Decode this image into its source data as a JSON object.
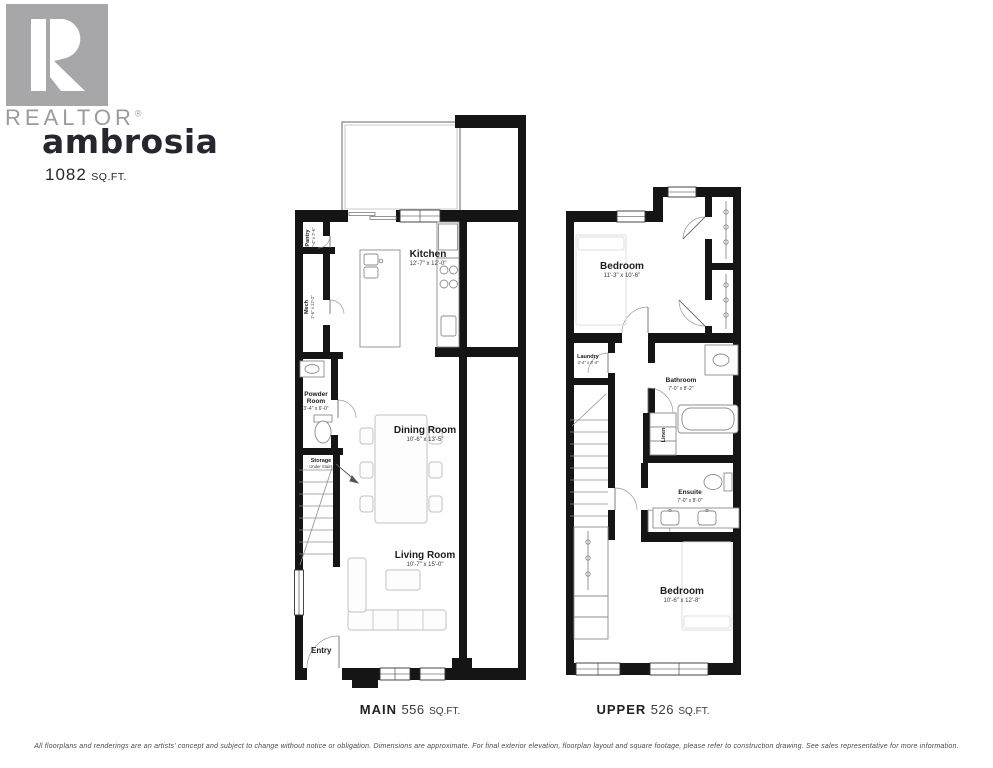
{
  "brand": {
    "realtor_label": "REALTOR",
    "registered_mark": "®"
  },
  "header": {
    "plan_name": "ambrosia",
    "total_area_value": "1082",
    "total_area_unit": "SQ.FT."
  },
  "floors": {
    "main": {
      "caption_name": "MAIN",
      "caption_area_value": "556",
      "caption_area_unit": "SQ.FT.",
      "rooms": {
        "kitchen": {
          "name": "Kitchen",
          "dims": "12'-7\" x 12'-0\""
        },
        "dining": {
          "name": "Dining Room",
          "dims": "10'-6\" x 13'-5\""
        },
        "living": {
          "name": "Living Room",
          "dims": "10'-7\" x 15'-0\""
        },
        "powder": {
          "line1": "Powder",
          "line2": "Room",
          "dims": "3'-4\" x 6'-0\""
        },
        "pantry": {
          "name": "Pantry",
          "dims": "2'-4\" x 2'-6\""
        },
        "mech": {
          "name": "Mech",
          "dims": "2'-6\" x 12'-2\""
        },
        "storage": {
          "line1": "Storage",
          "line2": "Under Stairs"
        },
        "entry": {
          "label": "Entry"
        }
      }
    },
    "upper": {
      "caption_name": "UPPER",
      "caption_area_value": "526",
      "caption_area_unit": "SQ.FT.",
      "rooms": {
        "bedroom1": {
          "name": "Bedroom",
          "dims": "11'-3\" x 10'-6\""
        },
        "bedroom2": {
          "name": "Bedroom",
          "dims": "10'-6\" x 12'-8\""
        },
        "bathroom": {
          "name": "Bathroom",
          "dims": "7'-0\" x 8'-2\""
        },
        "ensuite": {
          "name": "Ensuite",
          "dims": "7'-0\" x 8'-0\""
        },
        "laundry": {
          "name": "Laundry",
          "dims": "3'-4\" x 3'-4\""
        },
        "linen": {
          "label": "Linen"
        }
      }
    }
  },
  "footer": {
    "disclaimer": "All floorplans and renderings are an artists' concept and subject to change without notice or obligation. Dimensions are approximate. For final exterior elevation, floorplan layout and square footage, please refer to construction drawing. See sales representative for more information."
  },
  "colors": {
    "wall": "#151515",
    "logo_gray": "#a7a7a9",
    "fixture_gray": "#8c8c8c"
  }
}
